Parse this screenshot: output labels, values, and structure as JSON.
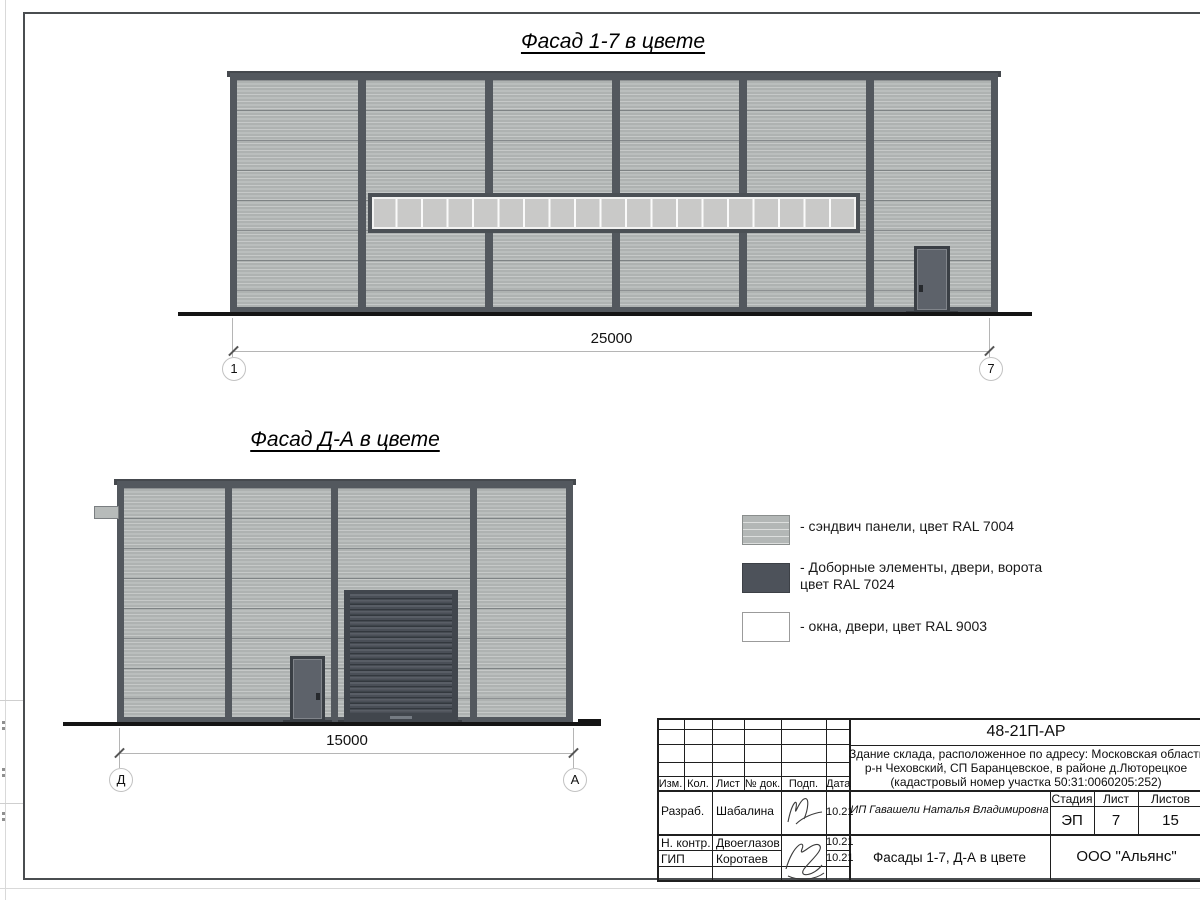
{
  "facades": {
    "top": {
      "title": "Фасад 1-7 в цвете",
      "dimension": "25000",
      "axis_left": "1",
      "axis_right": "7"
    },
    "bottom": {
      "title": "Фасад Д-А в цвете",
      "dimension": "15000",
      "axis_left": "Д",
      "axis_right": "А"
    }
  },
  "legend": {
    "items": [
      {
        "label": "- сэндвич панели, цвет RAL 7004"
      },
      {
        "label": "- Доборные элементы, двери, ворота",
        "label2": "цвет RAL 7024"
      },
      {
        "label": "- окна, двери, цвет RAL 9003"
      }
    ],
    "colors": {
      "panel": "#AEB2B1",
      "dark": "#4D525A",
      "white": "#FFFFFF"
    }
  },
  "stamp": {
    "code": "48-21П-АР",
    "description": {
      "line1": "Здание склада, расположенное по адресу: Московская область",
      "line2": "р-н Чеховский, СП Баранцевское, в районе д.Люторецкое",
      "line3": "(кадастровый номер участка 50:31:0060205:252)"
    },
    "columns": {
      "izm": "Изм.",
      "kol": "Кол.",
      "list": "Лист",
      "doc": "№ док.",
      "podp": "Подп.",
      "data": "Дата"
    },
    "labels": {
      "stage": "Стадия",
      "sheet": "Лист",
      "sheets": "Листов"
    },
    "values": {
      "stage": "ЭП",
      "sheet": "7",
      "sheets": "15"
    },
    "client": "ИП Гавашели Наталья Владимировна",
    "rows": [
      {
        "role": "Разраб.",
        "name": "Шабалина",
        "date": "10.21"
      },
      {
        "role": "Н. контр.",
        "name": "Двоеглазов",
        "date": "10.21"
      },
      {
        "role": "ГИП",
        "name": "Коротаев",
        "date": "10.21"
      }
    ],
    "drawing_title": "Фасады 1-7, Д-А в цвете",
    "company": "ООО \"Альянс\""
  }
}
